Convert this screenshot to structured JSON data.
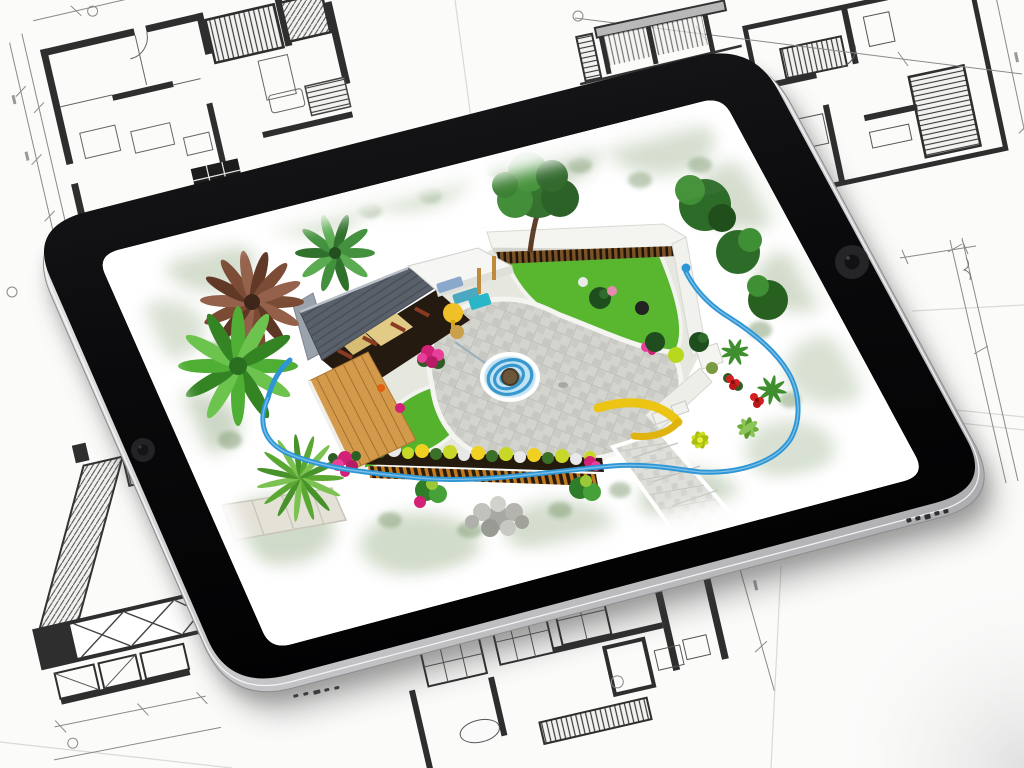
{
  "scene": {
    "description": "Photorealistic render of a black tablet lying on hand-sketched architectural blueprint sheets; the tablet screen displays a colorful 3D aerial garden landscape design",
    "background": {
      "label": "architectural blueprint sketches on white paper sheets",
      "paper_color": "#fbfbfa",
      "ink_color": "#2e2e2e",
      "light_line_color": "#8a8a8a"
    },
    "tablet": {
      "label": "black tablet with silver metal edge",
      "bezel_color": "#0a0a0c",
      "edge_color": "#c9c9cb",
      "front_camera_label": "front camera lens",
      "side_camera_label": "camera lens on bezel",
      "edge_buttons_label": "side buttons and speaker ports"
    },
    "screen": {
      "label": "garden landscape design rendering",
      "elements": {
        "pavilion": "pavilion with gray shingle roof and white flat roof over blue and yellow lounge furniture",
        "deck": "orange wooden plank deck",
        "walls": "white perimeter garden walls with wooden slat fence",
        "tree": "large green tree at top wall",
        "lawns": "bright green lawn areas",
        "plaza": "central gray cobblestone plaza",
        "water_feature": "blue spiral water feature with round well",
        "hose": "blue garden hose looping around the yard",
        "hedge": "flower hedge row with yellow, green and white plants",
        "paths": "stone walkway and slab path",
        "plants": "palms, agave, ferns, bushes",
        "flowers": "magenta peonies, pink roses, red hibiscus, lime lotus",
        "rocks": "gray rock pile on grass"
      },
      "palette": {
        "lawn_green": "#55b42e",
        "foliage_wash": "#a9bc9d",
        "cobble_gray": "#d4d4cf",
        "roof_gray": "#59606a",
        "deck_wood": "#d49a4c",
        "hose_blue": "#2e96d4",
        "water_blue": "#4aa8dc",
        "flower_magenta": "#d12277",
        "flower_red": "#d42020",
        "accent_yellow": "#ecc414"
      }
    }
  }
}
